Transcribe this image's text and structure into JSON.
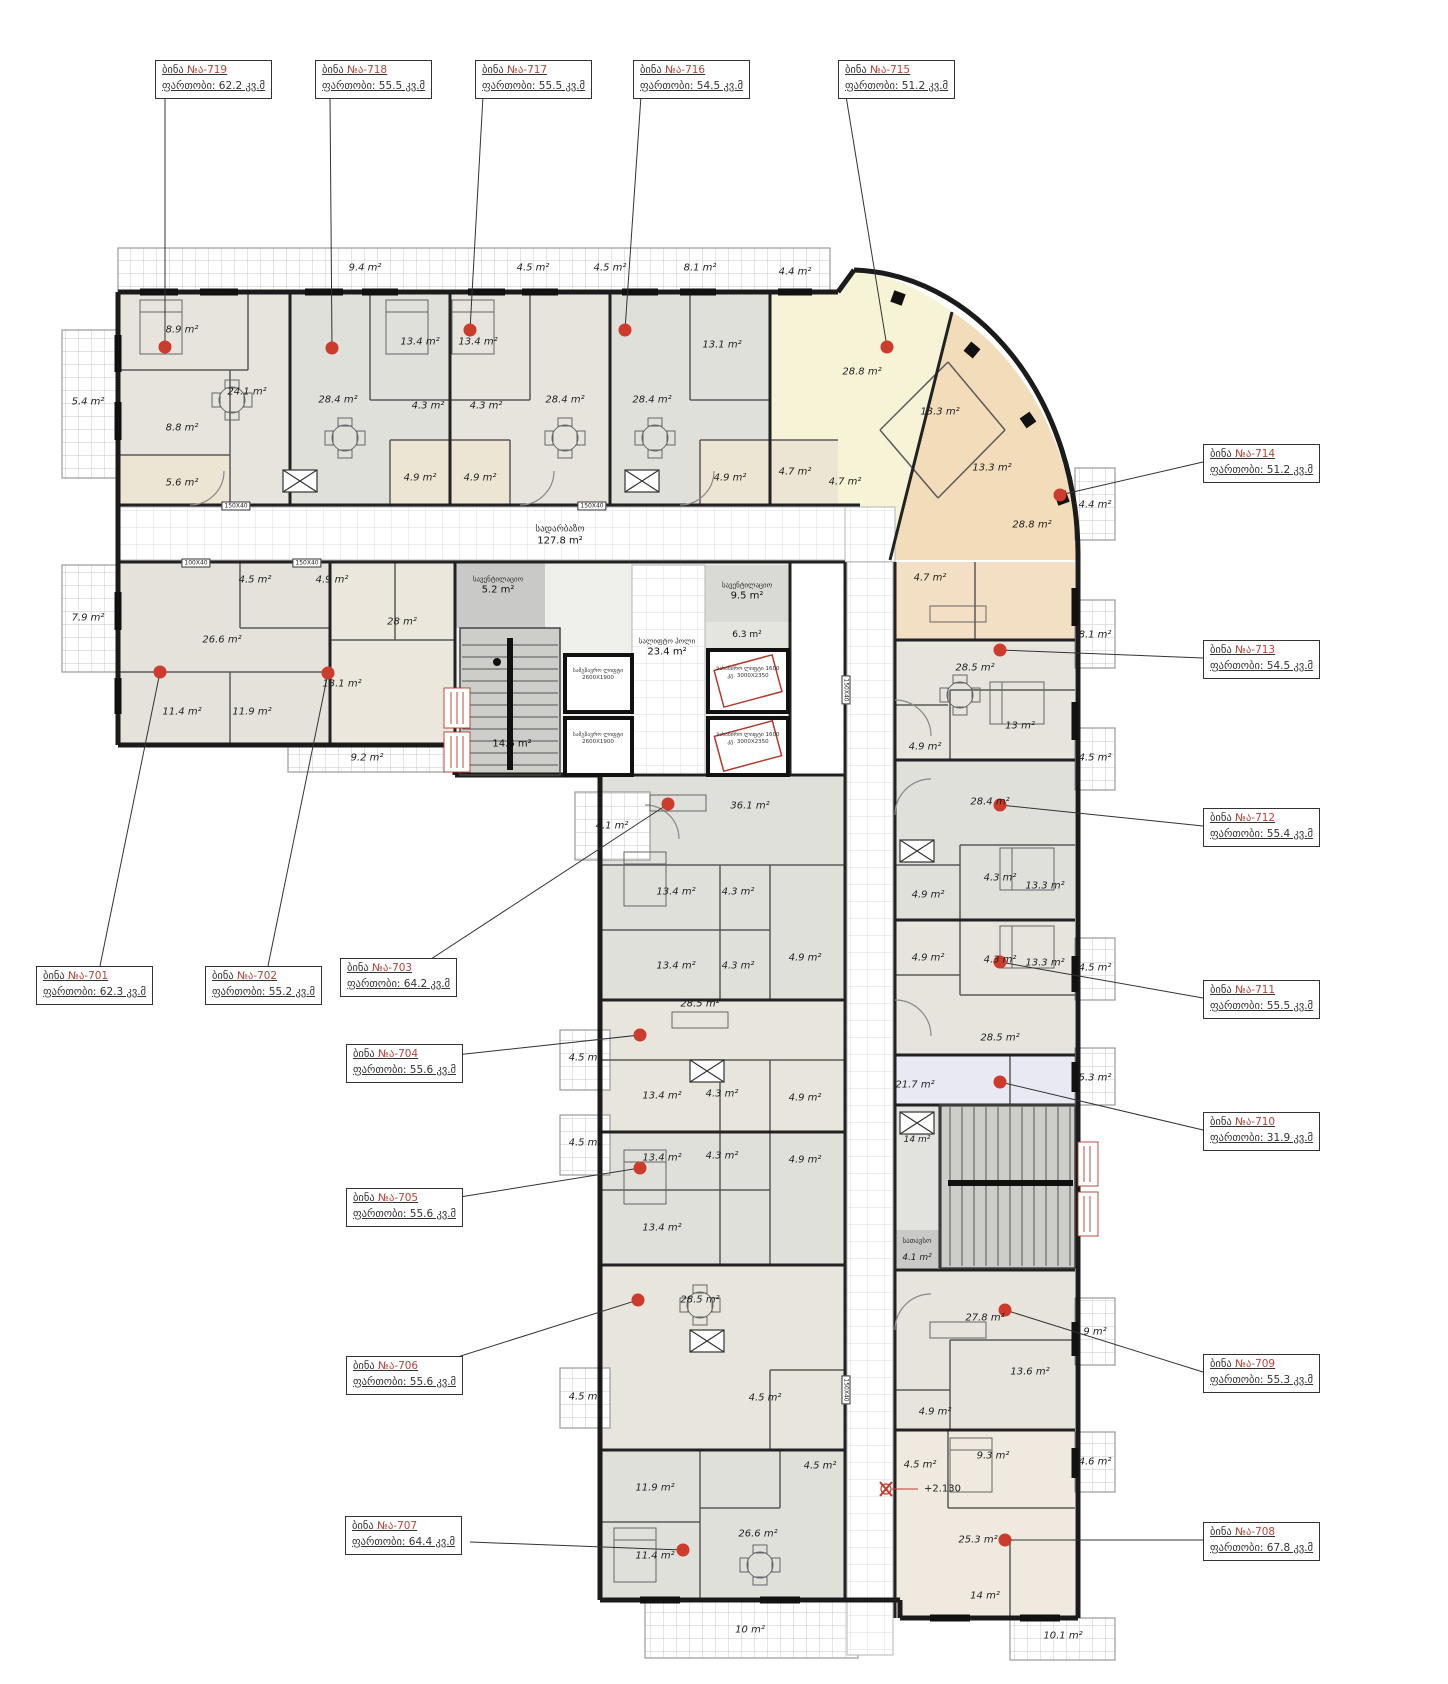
{
  "callouts": [
    {
      "apt": "ბინა",
      "no": "№ა-719",
      "area": "ფართობი: 62.2 კვ.მ"
    },
    {
      "apt": "ბინა",
      "no": "№ა-718",
      "area": "ფართობი: 55.5 კვ.მ"
    },
    {
      "apt": "ბინა",
      "no": "№ა-717",
      "area": "ფართობი: 55.5 კვ.მ"
    },
    {
      "apt": "ბინა",
      "no": "№ა-716",
      "area": "ფართობი: 54.5 კვ.მ"
    },
    {
      "apt": "ბინა",
      "no": "№ა-715",
      "area": "ფართობი: 51.2 კვ.მ"
    },
    {
      "apt": "ბინა",
      "no": "№ა-714",
      "area": "ფართობი: 51.2 კვ.მ"
    },
    {
      "apt": "ბინა",
      "no": "№ა-713",
      "area": "ფართობი: 54.5 კვ.მ"
    },
    {
      "apt": "ბინა",
      "no": "№ა-712",
      "area": "ფართობი: 55.4 კვ.მ"
    },
    {
      "apt": "ბინა",
      "no": "№ა-711",
      "area": "ფართობი: 55.5 კვ.მ"
    },
    {
      "apt": "ბინა",
      "no": "№ა-710",
      "area": "ფართობი: 31.9 კვ.მ"
    },
    {
      "apt": "ბინა",
      "no": "№ა-709",
      "area": "ფართობი: 55.3 კვ.მ"
    },
    {
      "apt": "ბინა",
      "no": "№ა-708",
      "area": "ფართობი: 67.8 კვ.მ"
    },
    {
      "apt": "ბინა",
      "no": "№ა-701",
      "area": "ფართობი: 62.3 კვ.მ"
    },
    {
      "apt": "ბინა",
      "no": "№ა-702",
      "area": "ფართობი: 55.2 კვ.მ"
    },
    {
      "apt": "ბინა",
      "no": "№ა-703",
      "area": "ფართობი: 64.2 კვ.მ"
    },
    {
      "apt": "ბინა",
      "no": "№ა-704",
      "area": "ფართობი: 55.6 კვ.მ"
    },
    {
      "apt": "ბინა",
      "no": "№ა-705",
      "area": "ფართობი: 55.6 კვ.მ"
    },
    {
      "apt": "ბინა",
      "no": "№ა-706",
      "area": "ფართობი: 55.6 კვ.მ"
    },
    {
      "apt": "ბინა",
      "no": "№ა-707",
      "area": "ფართობი: 64.4 კვ.მ"
    }
  ],
  "rooms": [
    {
      "a": "9.4 m²"
    },
    {
      "a": "4.5 m²"
    },
    {
      "a": "4.5 m²"
    },
    {
      "a": "8.1 m²"
    },
    {
      "a": "4.4 m²"
    },
    {
      "a": "5.4 m²"
    },
    {
      "a": "8.9 m²"
    },
    {
      "a": "24.1 m²"
    },
    {
      "a": "8.8 m²"
    },
    {
      "a": "5.6 m²"
    },
    {
      "a": "13.4 m²"
    },
    {
      "a": "28.4 m²"
    },
    {
      "a": "4.3 m²"
    },
    {
      "a": "4.9 m²"
    },
    {
      "a": "13.4 m²"
    },
    {
      "a": "28.4 m²"
    },
    {
      "a": "4.3 m²"
    },
    {
      "a": "4.9 m²"
    },
    {
      "a": "28.4 m²"
    },
    {
      "a": "13.1 m²"
    },
    {
      "a": "4.9 m²"
    },
    {
      "a": "4.7 m²"
    },
    {
      "a": "28.8 m²"
    },
    {
      "a": "13.3 m²"
    },
    {
      "a": "4.7 m²"
    },
    {
      "a": "13.3 m²"
    },
    {
      "a": "28.8 m²"
    },
    {
      "a": "4.7 m²"
    },
    {
      "a": "4.4 m²"
    },
    {
      "a": "28.5 m²"
    },
    {
      "a": "13 m²"
    },
    {
      "a": "4.9 m²"
    },
    {
      "a": "8.1 m²"
    },
    {
      "a": "28.4 m²"
    },
    {
      "a": "4.5 m²"
    },
    {
      "a": "4.3 m²"
    },
    {
      "a": "13.3 m²"
    },
    {
      "a": "4.9 m²"
    },
    {
      "a": "4.9 m²"
    },
    {
      "a": "4.3 m²"
    },
    {
      "a": "13.3 m²"
    },
    {
      "a": "28.5 m²"
    },
    {
      "a": "4.5 m²"
    },
    {
      "a": "21.7 m²"
    },
    {
      "a": "5.3 m²"
    },
    {
      "a": "14 m²"
    },
    {
      "a": "4.1 m²"
    },
    {
      "a": "27.8 m²"
    },
    {
      "a": "13.6 m²"
    },
    {
      "a": "4.9 m²"
    },
    {
      "a": "4.5 m²"
    },
    {
      "a": "9 m²"
    },
    {
      "a": "9.3 m²"
    },
    {
      "a": "25.3 m²"
    },
    {
      "a": "14 m²"
    },
    {
      "a": "4.6 m²"
    },
    {
      "a": "10.1 m²"
    },
    {
      "a": "7.9 m²"
    },
    {
      "a": "26.6 m²"
    },
    {
      "a": "4.5 m²"
    },
    {
      "a": "11.4 m²"
    },
    {
      "a": "11.9 m²"
    },
    {
      "a": "4.9 m²"
    },
    {
      "a": "13.1 m²"
    },
    {
      "a": "28 m²"
    },
    {
      "a": "9.2 m²"
    },
    {
      "a": "4.1 m²"
    },
    {
      "a": "36.1 m²"
    },
    {
      "a": "13.4 m²"
    },
    {
      "a": "4.3 m²"
    },
    {
      "a": "13.4 m²"
    },
    {
      "a": "4.3 m²"
    },
    {
      "a": "4.9 m²"
    },
    {
      "a": "4.5 m²"
    },
    {
      "a": "28.5 m²"
    },
    {
      "a": "13.4 m²"
    },
    {
      "a": "4.3 m²"
    },
    {
      "a": "4.9 m²"
    },
    {
      "a": "4.5 m²"
    },
    {
      "a": "13.4 m²"
    },
    {
      "a": "4.3 m²"
    },
    {
      "a": "4.9 m²"
    },
    {
      "a": "13.4 m²"
    },
    {
      "a": "28.5 m²"
    },
    {
      "a": "4.5 m²"
    },
    {
      "a": "4.5 m²"
    },
    {
      "a": "11.9 m²"
    },
    {
      "a": "11.4 m²"
    },
    {
      "a": "26.6 m²"
    },
    {
      "a": "4.5 m²"
    },
    {
      "a": "10 m²"
    }
  ],
  "core": {
    "corridor_name": "სადარბაზო",
    "corridor_area": "127.8 m²",
    "vent_name": "სავენტილაციო",
    "vent_area": "5.2 m²",
    "vent2_area": "9.5 m²",
    "hall_small_area": "6.3 m²",
    "lift_hall_name": "სალიფტო ჰოლი",
    "lift_hall_area": "23.4 m²",
    "stairs_area": "14.6 m²",
    "storage_name": "სათავსო",
    "lift_pass": "სამგზავრო ლიფტი 2600X1900",
    "lift_fire": "სახანძრო ლიფტი 1600 კგ. 3000X2350",
    "level_mark": "+2.130",
    "tag150": "150X40",
    "tag100": "100X40"
  }
}
